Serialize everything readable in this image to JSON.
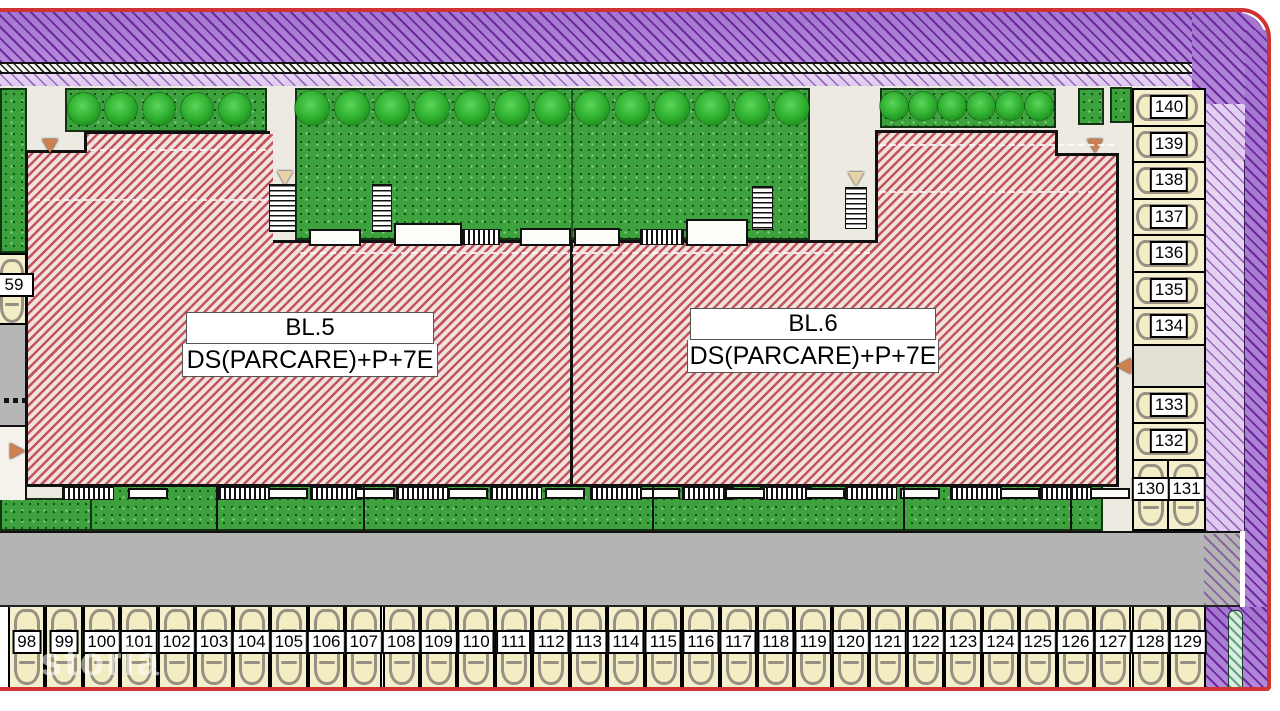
{
  "buildings": [
    {
      "name": "BL.5",
      "spec": "DS(PARCARE)+P+7E"
    },
    {
      "name": "BL.6",
      "spec": "DS(PARCARE)+P+7E"
    }
  ],
  "parking": {
    "left_edge_space": "59",
    "bottom_row": [
      "98",
      "99",
      "100",
      "101",
      "102",
      "103",
      "104",
      "105",
      "106",
      "107",
      "108",
      "109",
      "110",
      "111",
      "112",
      "113",
      "114",
      "115",
      "116",
      "117",
      "118",
      "119",
      "120",
      "121",
      "122",
      "123",
      "124",
      "125",
      "126",
      "127",
      "128",
      "129"
    ],
    "right_column_upper": [
      "140",
      "139",
      "138",
      "137",
      "136",
      "135",
      "134"
    ],
    "right_column_lower": [
      "133",
      "132"
    ],
    "right_column_bottom_pair": [
      "130",
      "131"
    ]
  },
  "watermark": "storia",
  "icons": {
    "tree": "tree-icon",
    "car": "car-icon",
    "stairs": "stairs-icon",
    "entrance_arrow": "entrance-arrow-icon"
  },
  "colors": {
    "building_hatch": "#c25559",
    "band_dark_purple": "#8a4cb8",
    "band_light_purple": "#e3d2f0",
    "grass": "#3da23d",
    "road": "#b6b6b6",
    "parking_cell": "#f4f0cd",
    "outer_border_red": "#cf3333"
  }
}
